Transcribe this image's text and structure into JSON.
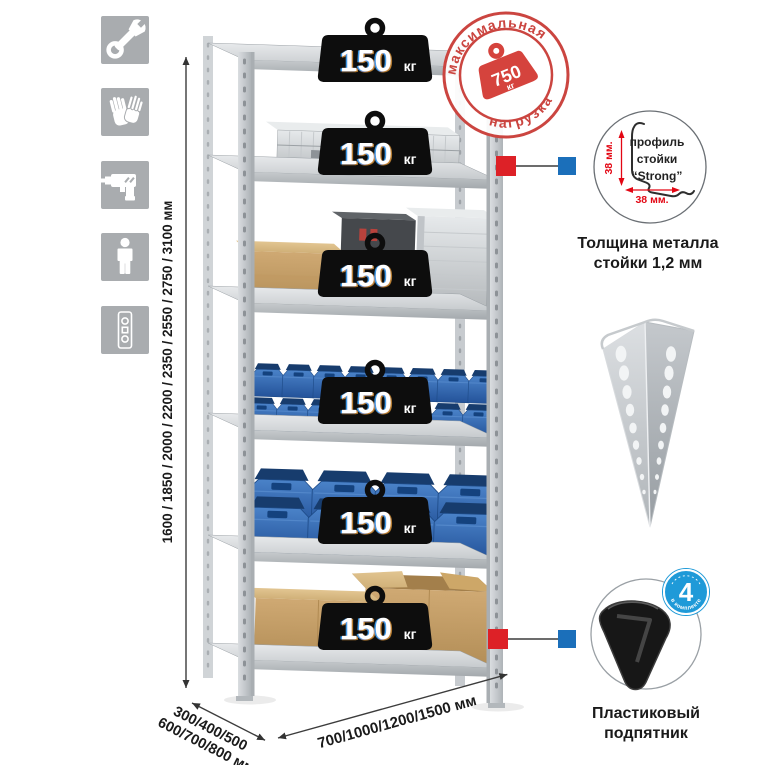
{
  "illustration": {
    "shelf_count": 6,
    "shelf_load": {
      "value": "150",
      "unit": "кг"
    },
    "stamp": {
      "arc_top": "максимальная",
      "arc_bottom": "нагрузка",
      "value": "750",
      "unit": "кг"
    }
  },
  "sidebar_icons": [
    {
      "name": "wrench-icon"
    },
    {
      "name": "gloves-icon"
    },
    {
      "name": "drill-icon"
    },
    {
      "name": "person-icon"
    },
    {
      "name": "rack-post-icon"
    }
  ],
  "dimensions": {
    "height_options": "1600 / 1850 / 2000 / 2200 / 2350 / 2550 / 2750 / 3100 мм",
    "depth_line1": "300/400/500",
    "depth_line2": "600/700/800 мм",
    "width_options": "700/1000/1200/1500 мм"
  },
  "profile_detail": {
    "label_line1": "профиль",
    "label_line2": "стойки",
    "label_line3": "“Strong”",
    "dim_vertical": "38 мм.",
    "dim_horizontal": "38 мм.",
    "caption_line1": "Толщина металла",
    "caption_line2": "стойки 1,2 мм"
  },
  "foot_detail": {
    "badge_value": "4",
    "badge_arc": "в комплекте",
    "caption_line1": "Пластиковый",
    "caption_line2": "подпятник"
  },
  "colors": {
    "icon_gray": "#a9acaf",
    "metal_gray": "#c9cdd0",
    "bin_blue": "#2e66ae",
    "stamp_red": "#cb4540",
    "connector_red": "#dd2127",
    "connector_blue": "#1b6fba",
    "badge_blue": "#1f9ad8",
    "dim_red": "#e30613"
  }
}
